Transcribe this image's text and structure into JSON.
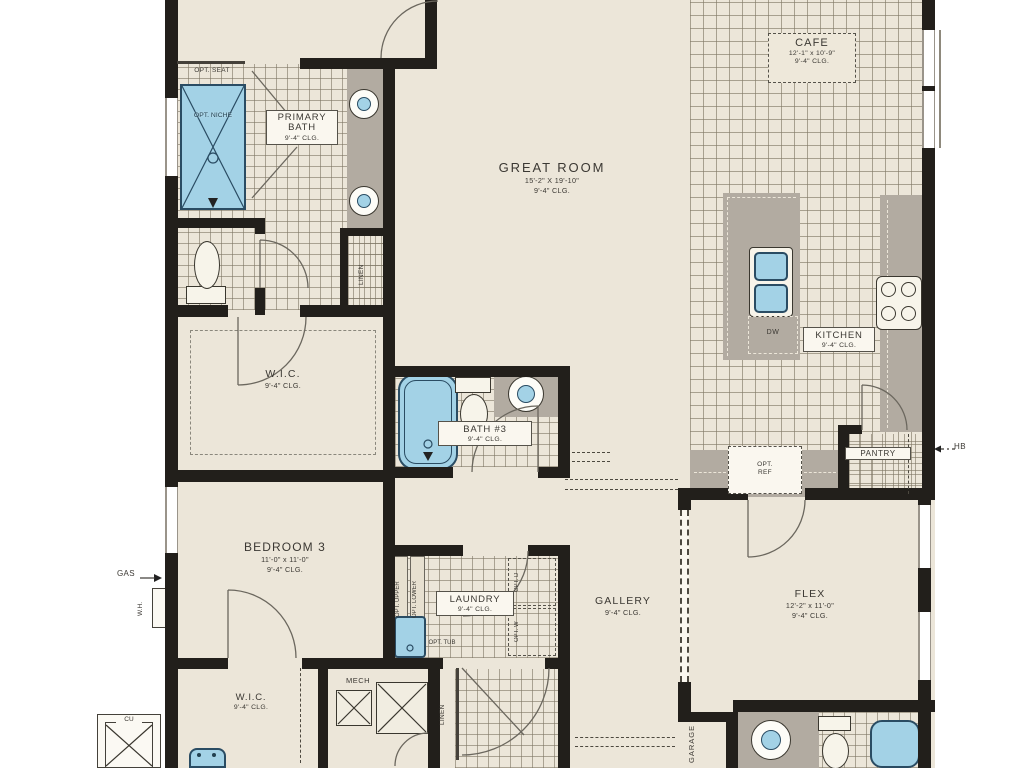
{
  "plan_title": "single-story floor plan",
  "colors": {
    "wall": "#221f1b",
    "floor": "#ece6d9",
    "tile_line": "#827a67",
    "counter": "#b2aba1",
    "fixture_blue": "#a3d2e6",
    "fixture_border": "#2a4c63",
    "label_text": "#3b3833"
  },
  "rooms": {
    "cafe": {
      "name": "CAFE",
      "dims": "12'-1\" x 10'-9\"",
      "ceiling": "9'-4\" CLG."
    },
    "great_room": {
      "name": "GREAT ROOM",
      "dims": "15'-2\" X 19'-10\"",
      "ceiling": "9'-4\" CLG."
    },
    "primary_bath": {
      "name": "PRIMARY BATH",
      "ceiling": "9'-4\" CLG."
    },
    "kitchen": {
      "name": "KITCHEN",
      "ceiling": "9'-4\" CLG."
    },
    "wic_primary": {
      "name": "W.I.C.",
      "ceiling": "9'-4\" CLG."
    },
    "bath3": {
      "name": "BATH #3",
      "ceiling": "9'-4\" CLG."
    },
    "bedroom3": {
      "name": "BEDROOM 3",
      "dims": "11'-0\" x 11'-0\"",
      "ceiling": "9'-4\" CLG."
    },
    "laundry": {
      "name": "LAUNDRY",
      "ceiling": "9'-4\" CLG."
    },
    "gallery": {
      "name": "GALLERY",
      "ceiling": "9'-4\" CLG."
    },
    "flex": {
      "name": "FLEX",
      "dims": "12'-2\" x 11'-0\"",
      "ceiling": "9'-4\" CLG."
    },
    "wic2": {
      "name": "W.I.C.",
      "ceiling": "9'-4\" CLG."
    },
    "mech": {
      "name": "MECH"
    },
    "pantry": {
      "name": "PANTRY"
    },
    "linen_primary": {
      "name": "LINEN"
    },
    "linen_hall": {
      "name": "LINEN"
    },
    "garage": {
      "name": "GARAGE"
    }
  },
  "annotations": {
    "opt_seat": "OPT. SEAT",
    "opt_niche": "OPT. NICHE",
    "opt_ref": "OPT. REF",
    "opt_upper": "OPT. UPPER",
    "opt_lower": "OPT. LOWER",
    "opt_tub": "OPT. TUB",
    "opt_dryer": "OPT. D",
    "opt_washer": "OPT. W",
    "dishwasher": "DW",
    "condenser": "CU",
    "gas": "GAS",
    "water_heater": "W.H.",
    "hose_bib": "HB"
  }
}
